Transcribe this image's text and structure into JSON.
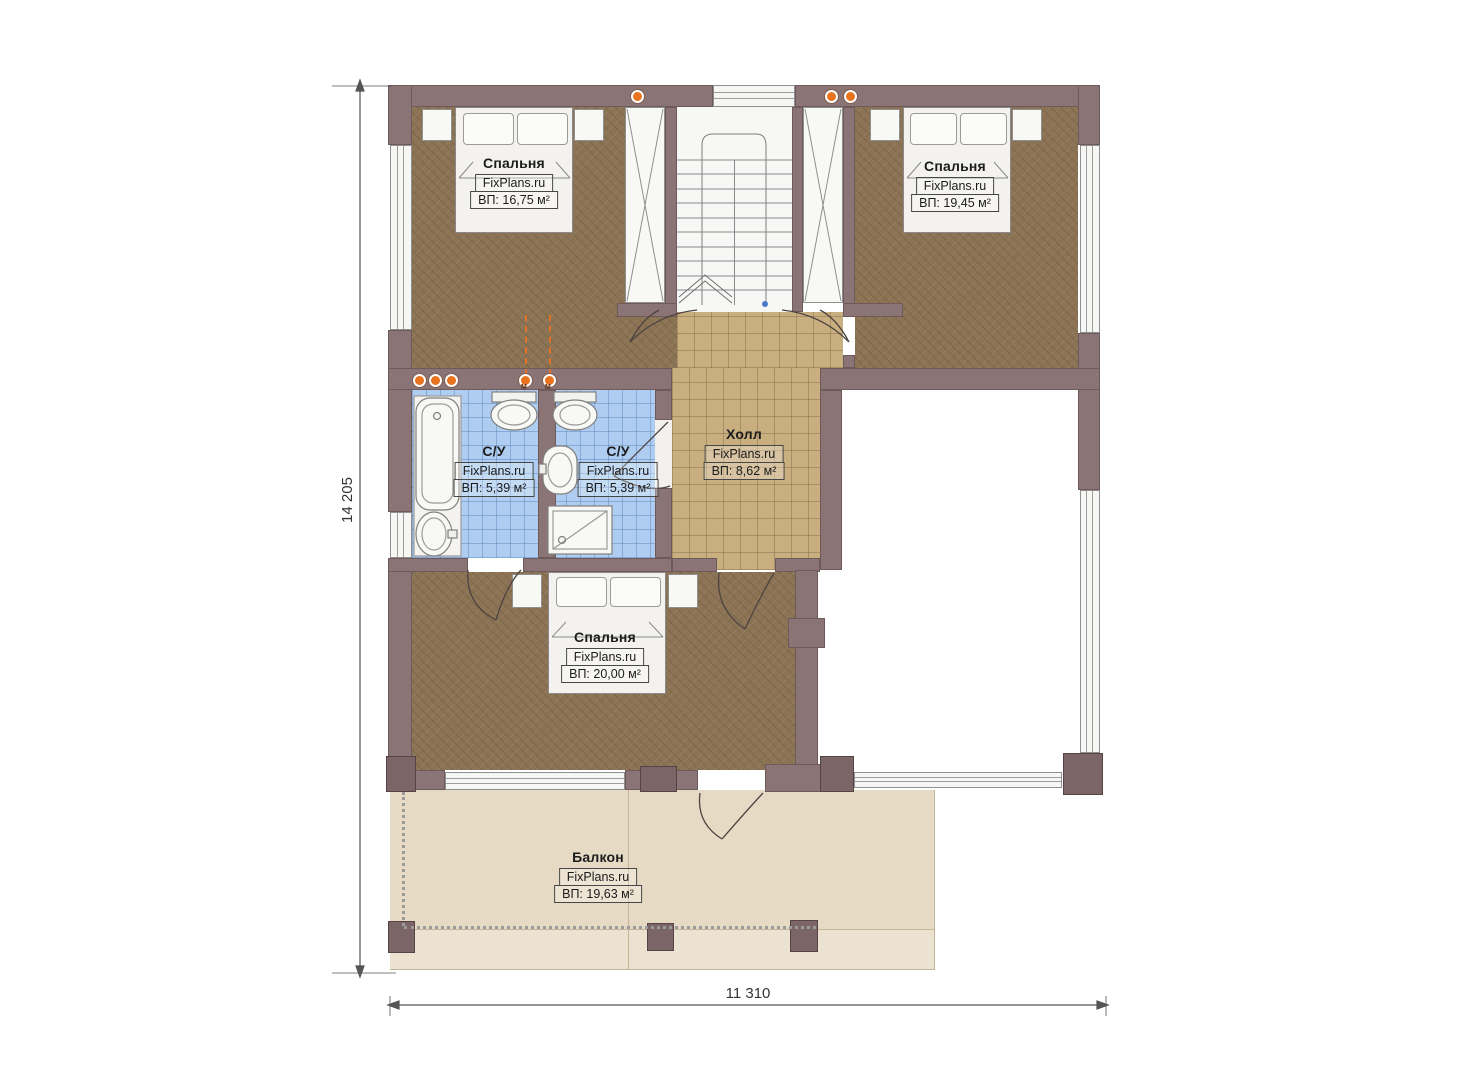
{
  "brand": "FixPlans.ru",
  "dimensions": {
    "height_label": "14 205",
    "width_label": "11 310"
  },
  "rooms": [
    {
      "id": "bedroom-top-left",
      "name": "Спальня",
      "brand": "FixPlans.ru",
      "area": "ВП: 16,75 м²"
    },
    {
      "id": "bedroom-top-right",
      "name": "Спальня",
      "brand": "FixPlans.ru",
      "area": "ВП: 19,45 м²"
    },
    {
      "id": "bathroom-left",
      "name": "С/У",
      "brand": "FixPlans.ru",
      "area": "ВП: 5,39 м²"
    },
    {
      "id": "bathroom-right",
      "name": "С/У",
      "brand": "FixPlans.ru",
      "area": "ВП: 5,39 м²"
    },
    {
      "id": "hall",
      "name": "Холл",
      "brand": "FixPlans.ru",
      "area": "ВП: 8,62 м²"
    },
    {
      "id": "bedroom-bottom",
      "name": "Спальня",
      "brand": "FixPlans.ru",
      "area": "ВП: 20,00 м²"
    },
    {
      "id": "balcony",
      "name": "Балкон",
      "brand": "FixPlans.ru",
      "area": "ВП: 19,63 м²"
    }
  ],
  "vent_marker": "М",
  "colors": {
    "wall": "#8a7476",
    "wall_dark": "#7c6567",
    "bedroom_floor": "#8b7354",
    "hall_floor": "#c9ae80",
    "bath_floor": "#aecdf0",
    "balcony_floor": "#e6dac4",
    "accent_orange": "#ea7320"
  }
}
